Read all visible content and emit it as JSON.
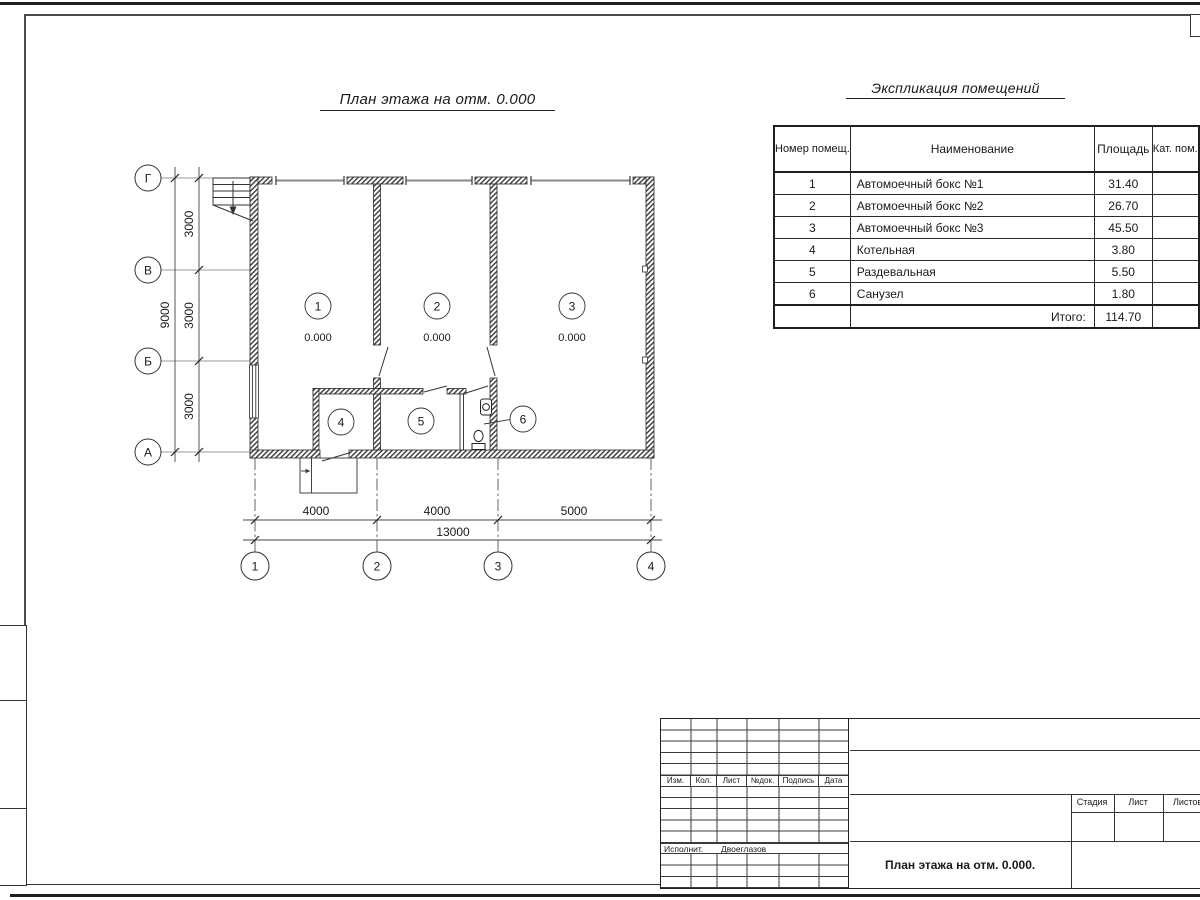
{
  "plan": {
    "title": "План этажа на отм. 0.000",
    "axes_rows": [
      "Г",
      "В",
      "Б",
      "А"
    ],
    "axes_cols": [
      "1",
      "2",
      "3",
      "4"
    ],
    "dims": {
      "left_segments": [
        "3000",
        "3000",
        "3000"
      ],
      "left_total": "9000",
      "bottom_segments": [
        "4000",
        "4000",
        "5000"
      ],
      "bottom_total": "13000"
    },
    "rooms": [
      {
        "num": "1",
        "elev": "0.000"
      },
      {
        "num": "2",
        "elev": "0.000"
      },
      {
        "num": "3",
        "elev": "0.000"
      },
      {
        "num": "4"
      },
      {
        "num": "5"
      },
      {
        "num": "6"
      }
    ],
    "icons": {
      "stairs": "stairs-symbol",
      "sink": "sink-symbol",
      "toilet": "toilet-symbol",
      "doors": "door-swing-symbol"
    }
  },
  "explication": {
    "title": "Экспликация помещений",
    "headers": {
      "num": "Номер помещ.",
      "name": "Наименование",
      "area": "Площадь",
      "cat": "Кат. пом."
    },
    "rows": [
      {
        "num": "1",
        "name": "Автомоечный бокс №1",
        "area": "31.40",
        "cat": ""
      },
      {
        "num": "2",
        "name": "Автомоечный бокс №2",
        "area": "26.70",
        "cat": ""
      },
      {
        "num": "3",
        "name": "Автомоечный бокс №3",
        "area": "45.50",
        "cat": ""
      },
      {
        "num": "4",
        "name": "Котельная",
        "area": "3.80",
        "cat": ""
      },
      {
        "num": "5",
        "name": "Раздевальная",
        "area": "5.50",
        "cat": ""
      },
      {
        "num": "6",
        "name": "Санузел",
        "area": "1.80",
        "cat": ""
      }
    ],
    "total_label": "Итого:",
    "total_value": "114.70"
  },
  "titleblock": {
    "cols": [
      "Изм.",
      "Кол.",
      "Лист",
      "№док.",
      "Подпись",
      "Дата"
    ],
    "executor_label": "Исполнит.",
    "executor_name": "Двоеглазов",
    "stage_label": "Стадия",
    "sheet_label": "Лист",
    "sheets_label": "Листов",
    "doc_title": "План этажа на отм. 0.000."
  },
  "colors": {
    "line": "#2a2a2a",
    "gate_line": "#888888",
    "axis_line": "#666666"
  }
}
